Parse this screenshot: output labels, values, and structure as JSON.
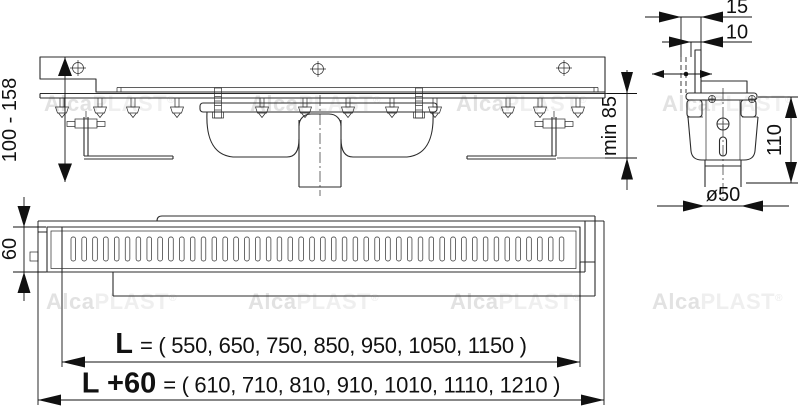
{
  "watermark": {
    "bold": "Alca",
    "light": "PLAST",
    "reg": "®"
  },
  "dims": {
    "height_range": "100 - 158",
    "min_depth": "min 85",
    "offset_top": "15",
    "offset_bottom": "10",
    "trap_height": "110",
    "outlet_diameter": "ø50",
    "channel_width": "60",
    "length_label": "L",
    "length_values": "= ( 550, 650, 750, 850, 950, 1050, 1150 )",
    "length_plus_label": "L +60",
    "length_plus_values": "= ( 610, 710, 810, 910, 1010, 1110, 1210 )"
  },
  "colors": {
    "line": "#2b2b2b",
    "dimension": "#111111",
    "watermark_bold": "#e2e2e2",
    "watermark_light": "#efefef",
    "background": "#ffffff"
  }
}
